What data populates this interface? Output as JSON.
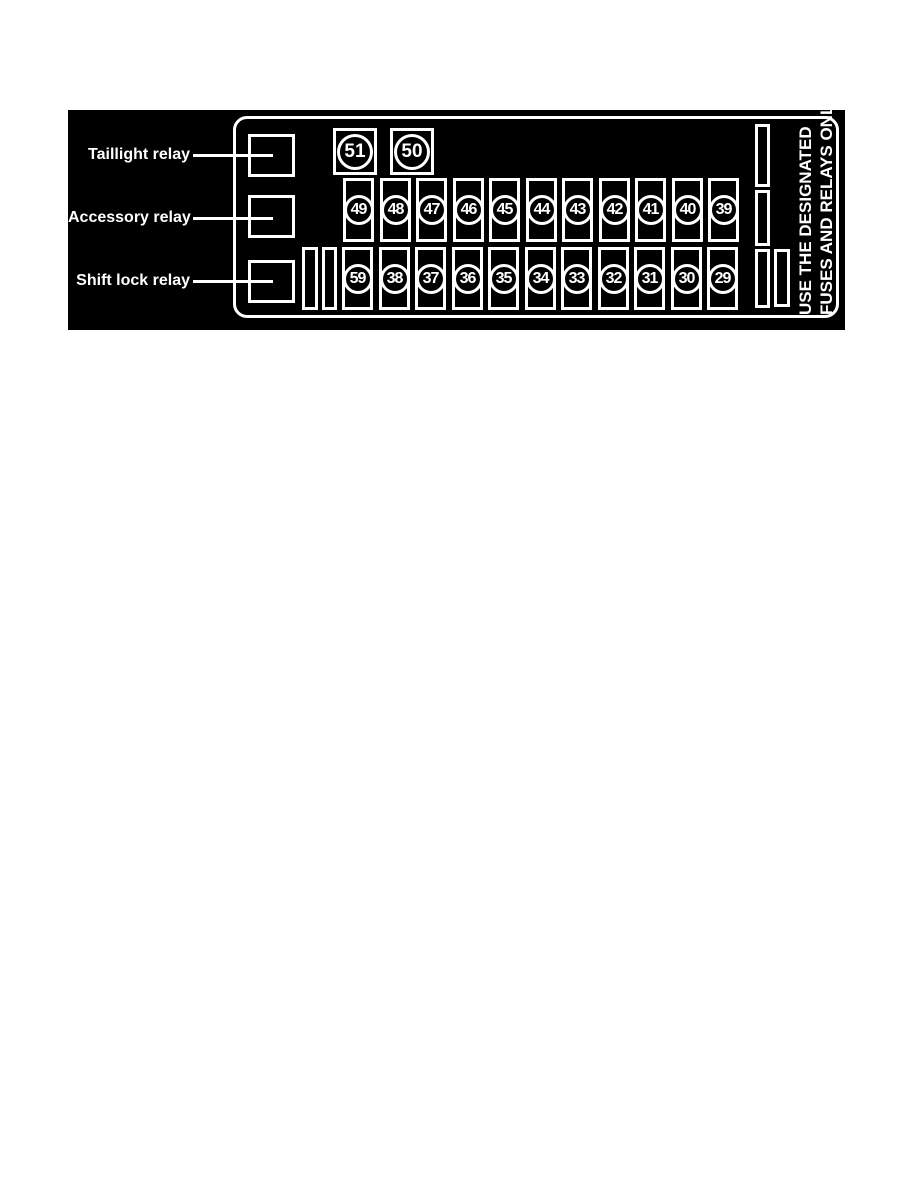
{
  "diagram": {
    "relays": [
      {
        "label": "Taillight relay"
      },
      {
        "label": "Accessory relay"
      },
      {
        "label": "Shift lock relay"
      }
    ],
    "top_row_fuses": [
      "51",
      "50"
    ],
    "middle_row_fuses": [
      "49",
      "48",
      "47",
      "46",
      "45",
      "44",
      "43",
      "42",
      "41",
      "40",
      "39"
    ],
    "bottom_row_fuses": [
      "59",
      "38",
      "37",
      "36",
      "35",
      "34",
      "33",
      "32",
      "31",
      "30",
      "29"
    ],
    "notice": {
      "line1": "USE THE DESIGNATED",
      "line2": "FUSES AND RELAYS ONLY"
    },
    "colors": {
      "panel_background": "#000000",
      "foreground": "#ffffff",
      "page_background": "#ffffff"
    }
  }
}
